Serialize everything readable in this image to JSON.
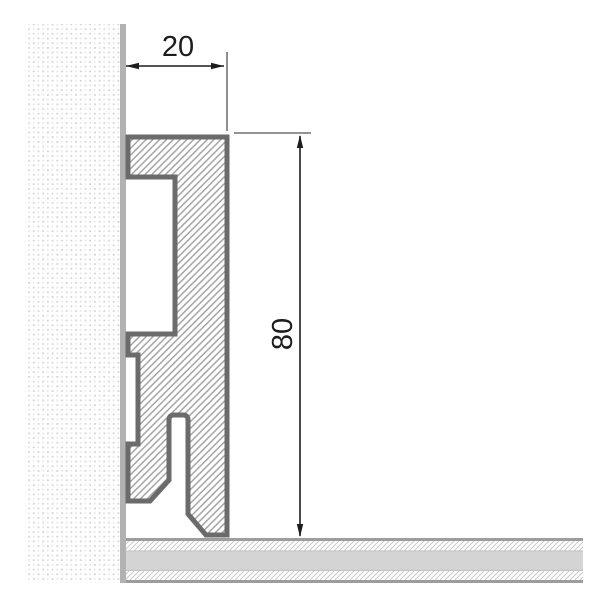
{
  "diagram": {
    "type": "technical-drawing",
    "subject": "skirting-board-cross-section",
    "dimensions": {
      "width": {
        "label": "20"
      },
      "height": {
        "label": "80"
      }
    },
    "colors": {
      "background": "#ffffff",
      "wall_dot": "#d3d3d3",
      "wall_dot_light": "#e4e4e4",
      "wall_edge": "#b2b2b2",
      "profile_outline": "#6b6b6b",
      "profile_hatch": "#9a9a9a",
      "floor_edge": "#9d9d9d",
      "floor_inner_line": "#bdbdbd",
      "floor_band": "#d4d4d4",
      "floor_hatch": "#c3c3c3",
      "dimension_line": "#1d1d1d",
      "extension_line": "#555555"
    }
  }
}
